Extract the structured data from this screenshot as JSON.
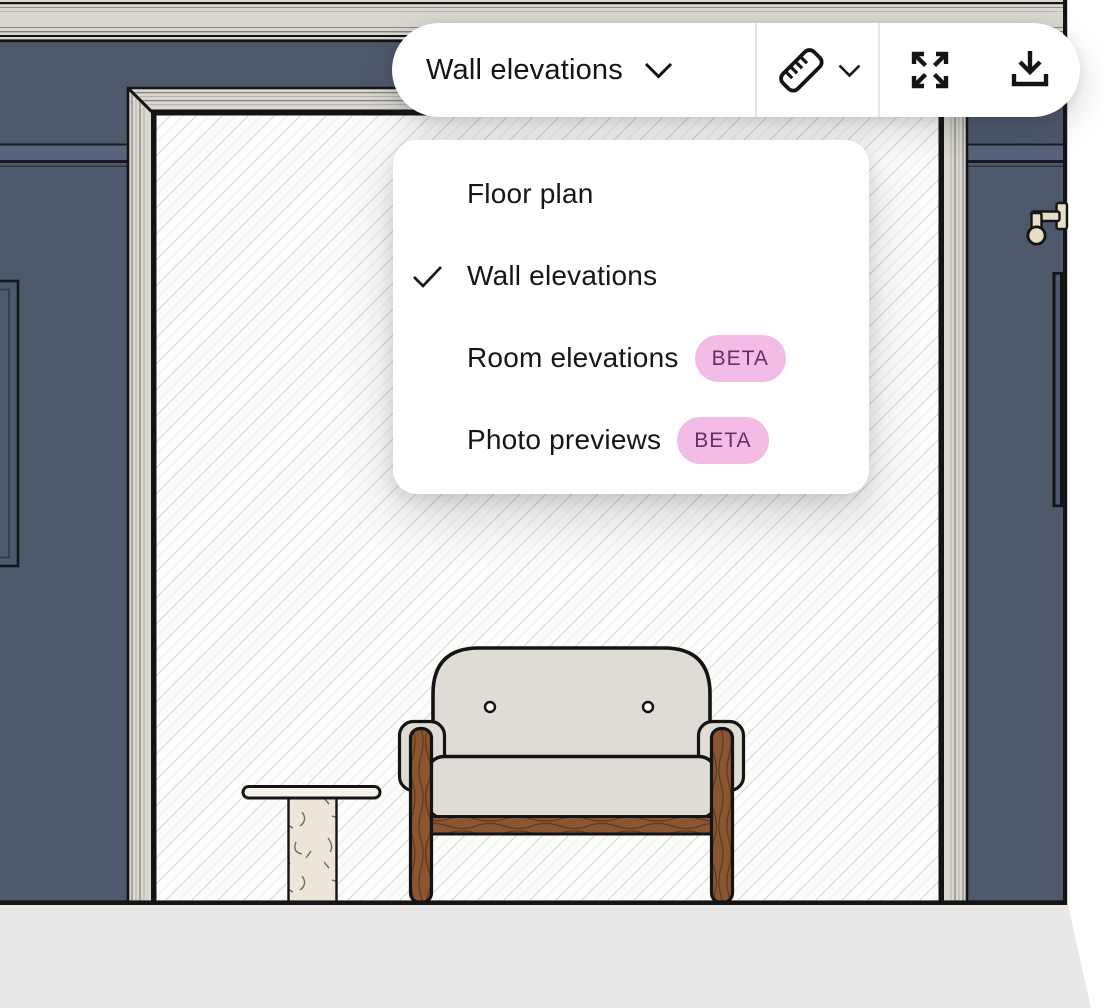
{
  "toolbar": {
    "view_dropdown": {
      "label": "Wall elevations",
      "icon": "chevron-down"
    },
    "measure_button": {
      "icon": "ruler",
      "secondary_icon": "chevron-down"
    },
    "fullscreen_button": {
      "icon": "expand-arrows"
    },
    "download_button": {
      "icon": "download"
    }
  },
  "view_menu": {
    "items": [
      {
        "label": "Floor plan",
        "checked": false,
        "badge": ""
      },
      {
        "label": "Wall elevations",
        "checked": true,
        "badge": ""
      },
      {
        "label": "Room elevations",
        "checked": false,
        "badge": "BETA"
      },
      {
        "label": "Photo previews",
        "checked": false,
        "badge": "BETA"
      }
    ]
  },
  "scene": {
    "type": "wall-elevation-drawing",
    "objects": [
      "crown-molding",
      "painted-wall",
      "wall-panel-molding",
      "chair-rail",
      "doorway-with-trim",
      "hatched-opening",
      "door-with-handle",
      "armchair",
      "side-table",
      "floor-section"
    ]
  },
  "colors": {
    "ink": "#141414",
    "wall": "#4e586b",
    "molding": "#d9d7d0",
    "floor": "#e9e8e6",
    "upholstery": "#dedcd4",
    "wood": "#8a5632",
    "wood_grain": "#5f3a1c",
    "marble": "#ece5da",
    "marble_vein": "#7b5737",
    "handle": "#e7dec6",
    "hatch_line": "#d7d7d5",
    "beta_bg": "#f2bce6",
    "beta_text": "#6e2b66"
  }
}
